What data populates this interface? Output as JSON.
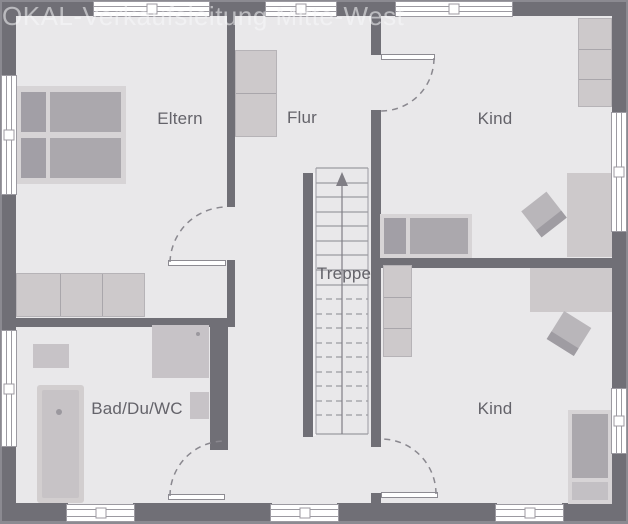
{
  "watermark": "OKAL-Verkaufsleitung Mitte-West",
  "plan": {
    "type": "floor-plan",
    "rooms": [
      {
        "id": "eltern",
        "label": "Eltern"
      },
      {
        "id": "flur",
        "label": "Flur"
      },
      {
        "id": "kind-top",
        "label": "Kind"
      },
      {
        "id": "treppe",
        "label": "Treppe"
      },
      {
        "id": "bad",
        "label": "Bad/Du/WC"
      },
      {
        "id": "kind-bottom",
        "label": "Kind"
      }
    ]
  },
  "colors": {
    "background": "#8b8a91",
    "floor": "#e9e8ea",
    "wall": "#706f76",
    "furniture_light": "#cdc9cb",
    "furniture_medium": "#aba8ad",
    "bed_pillow_dark": "#a29fa6",
    "bed_pillow_light": "#c3c0c4",
    "bed_frame": "#d7d4d6",
    "fixture": "#c7c3c7",
    "label_text": "#64636a",
    "line": "#9c9aa1",
    "dash": "#8a888f"
  }
}
